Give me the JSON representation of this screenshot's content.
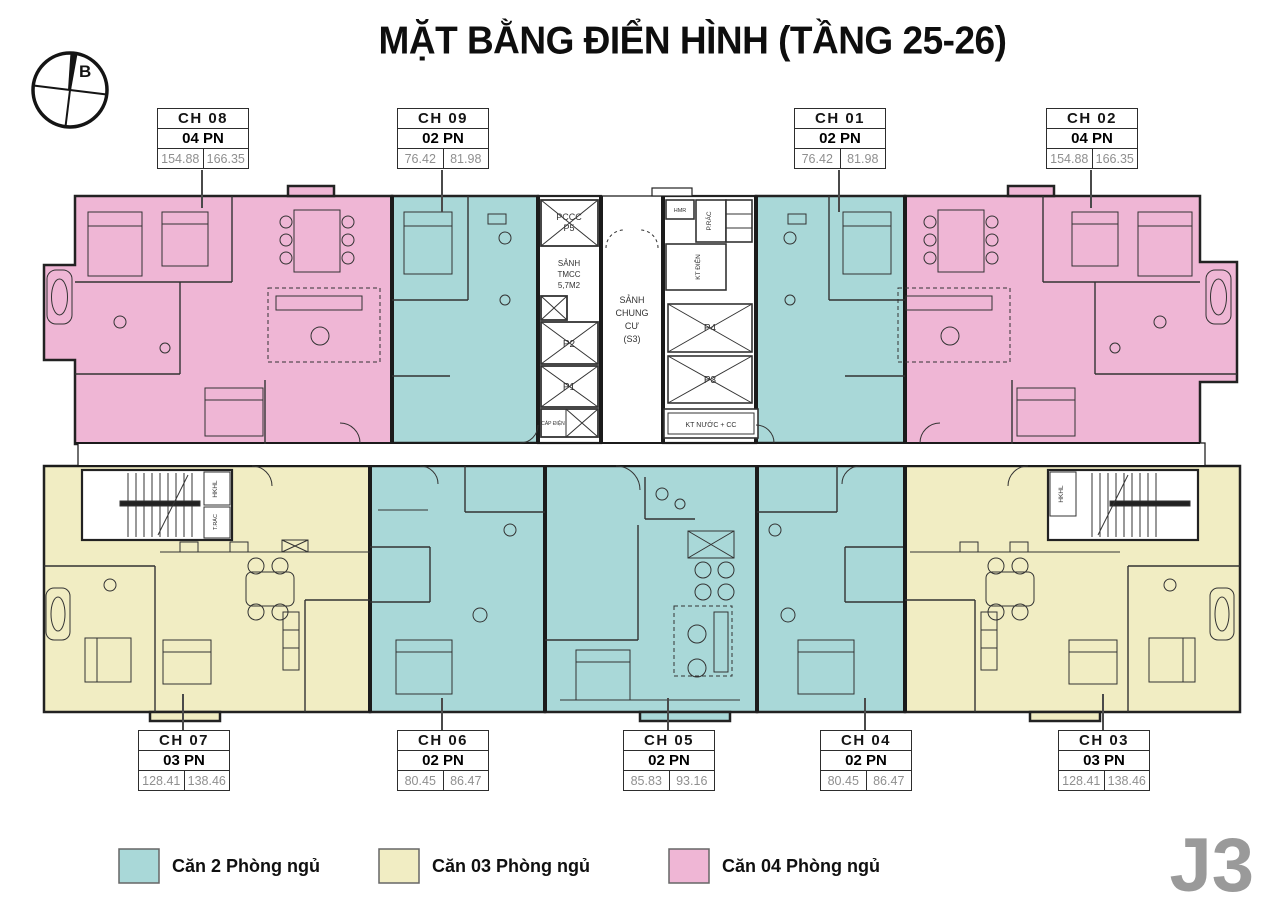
{
  "title": "MẶT BẰNG ĐIỂN HÌNH (TẦNG 25-26)",
  "compass_label": "B",
  "block_label": "J3",
  "units": [
    {
      "id": "CH 08",
      "bedrooms": "04 PN",
      "area_net": "154.88",
      "area_gross": "166.35",
      "type": "4pn"
    },
    {
      "id": "CH 09",
      "bedrooms": "02 PN",
      "area_net": "76.42",
      "area_gross": "81.98",
      "type": "2pn"
    },
    {
      "id": "CH 01",
      "bedrooms": "02 PN",
      "area_net": "76.42",
      "area_gross": "81.98",
      "type": "2pn"
    },
    {
      "id": "CH 02",
      "bedrooms": "04 PN",
      "area_net": "154.88",
      "area_gross": "166.35",
      "type": "4pn"
    },
    {
      "id": "CH 07",
      "bedrooms": "03 PN",
      "area_net": "128.41",
      "area_gross": "138.46",
      "type": "3pn"
    },
    {
      "id": "CH 06",
      "bedrooms": "02 PN",
      "area_net": "80.45",
      "area_gross": "86.47",
      "type": "2pn"
    },
    {
      "id": "CH 05",
      "bedrooms": "02 PN",
      "area_net": "85.83",
      "area_gross": "93.16",
      "type": "2pn"
    },
    {
      "id": "CH 04",
      "bedrooms": "02 PN",
      "area_net": "80.45",
      "area_gross": "86.47",
      "type": "2pn"
    },
    {
      "id": "CH 03",
      "bedrooms": "03 PN",
      "area_net": "128.41",
      "area_gross": "138.46",
      "type": "3pn"
    }
  ],
  "core": {
    "pccc_line1": "PCCC",
    "pccc_line2": "P5",
    "sanh_tmcc_line1": "SẢNH",
    "sanh_tmcc_line2": "TMCC",
    "sanh_tmcc_line3": "5,7M2",
    "p2": "P2",
    "p1": "P1",
    "cap_dien": "CÁP ĐIỆN",
    "lobby_line1": "SẢNH",
    "lobby_line2": "CHUNG",
    "lobby_line3": "CƯ",
    "lobby_line4": "(S3)",
    "hmr": "HMR",
    "p_rac": "P.RÁC",
    "kt_dien": "KT ĐIỆN",
    "p4": "P4",
    "p3": "P3",
    "kt_nuoc": "KT NƯỚC + CC",
    "stair_left_label": "HKHL",
    "stair_left_label2": "T.RÁC",
    "stair_right_label": "HKHL"
  },
  "legend": {
    "items": [
      {
        "label": "Căn 2 Phòng ngủ",
        "color": "#a9d8d8"
      },
      {
        "label": "Căn 03 Phòng ngủ",
        "color": "#f1edc3"
      },
      {
        "label": "Căn 04 Phòng ngủ",
        "color": "#efb6d5"
      }
    ]
  },
  "colors": {
    "two_pn": "#a9d8d8",
    "three_pn": "#f1edc3",
    "four_pn": "#efb6d5",
    "wall": "#222222"
  }
}
